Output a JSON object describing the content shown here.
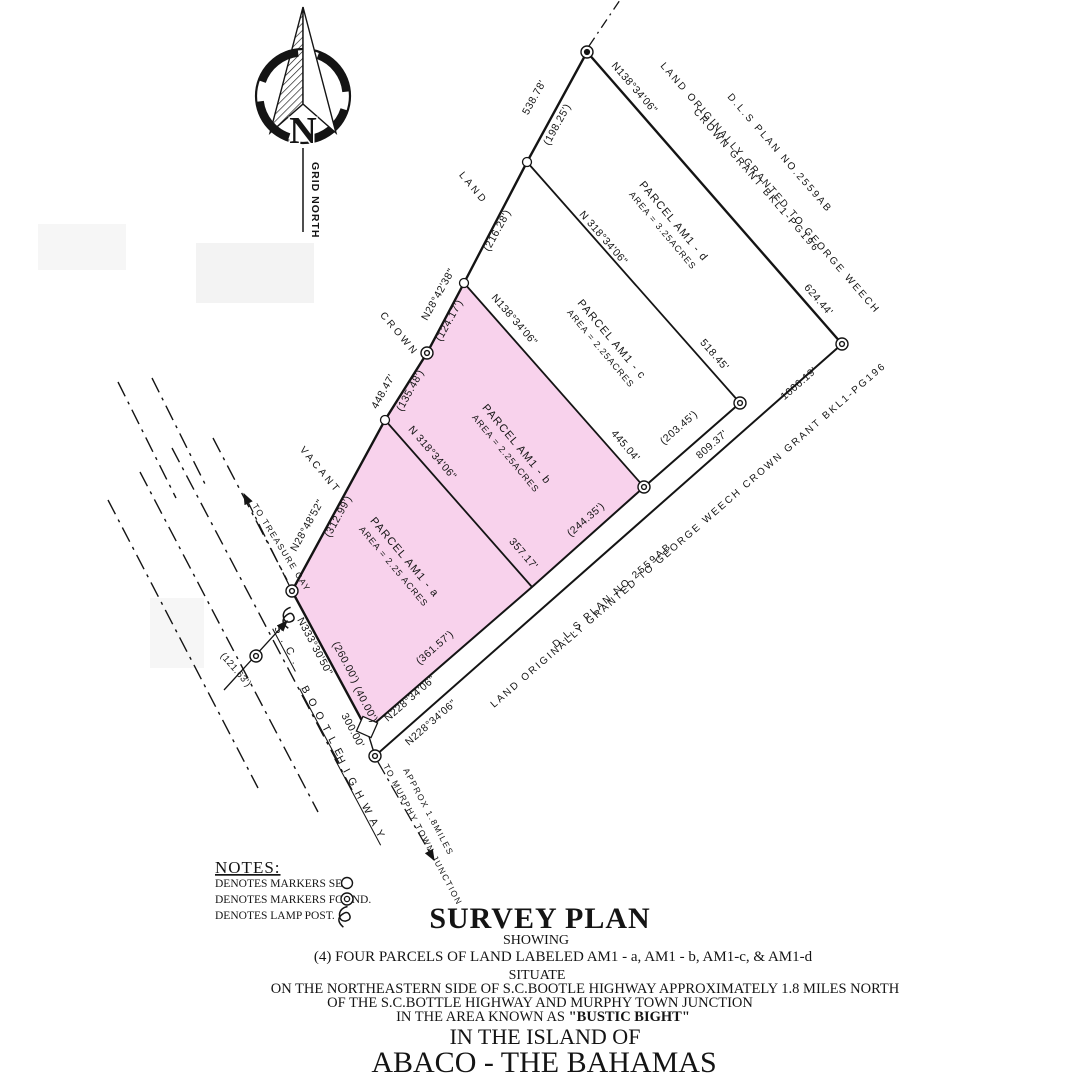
{
  "north_arrow": {
    "letter": "N",
    "caption": "GRID NORTH"
  },
  "parcels": {
    "d": {
      "name": "PARCEL AM1 - d",
      "area": "AREA = 3.25ACRES"
    },
    "c": {
      "name": "PARCEL AM1 - c",
      "area": "AREA = 2.25ACRES"
    },
    "b": {
      "name": "PARCEL AM1 - b",
      "area": "AREA = 2.25ACRES"
    },
    "a": {
      "name": "PARCEL AM1 - a",
      "area": "AREA = 2.25 ACRES"
    }
  },
  "measurements": {
    "nw_upper": {
      "bearing": "N28°42'38\"",
      "total": "538.78'",
      "seg1": "(198.25')",
      "seg2": "(216.28')",
      "seg3": "(124.17')"
    },
    "nw_lower": {
      "bearing": "N28°48'52\"",
      "total": "448.47'",
      "seg1": "(135.48')",
      "seg2": "(312.99')"
    },
    "ne": {
      "bearing": "N138°34'06\"",
      "dist": "624.44'"
    },
    "div_cd": {
      "bearing": "N 318°34'06\"",
      "dist": "518.45'"
    },
    "div_bc": {
      "bearing": "N138°34'06\"",
      "dist": "445.04'"
    },
    "div_ab": {
      "bearing": "N 318°34'06\"",
      "dist": "357.17'"
    },
    "se_inner": {
      "bearing": "N228°34'06\"",
      "total": "809.37'",
      "seg_a": "(361.57')",
      "seg_b": "(244.35')",
      "seg_c": "(203.45')"
    },
    "se_outer": {
      "bearing": "N228°34'06\"",
      "dist": "1006.19'"
    },
    "frontage": {
      "bearing": "N333°30'50\"",
      "total": "300.00'",
      "seg1": "(260.00')",
      "seg2": "(40.00')"
    },
    "tie": {
      "dist": "(121.63')"
    }
  },
  "adjoining": {
    "vacant": "VACANT",
    "crown": "CROWN",
    "land": "LAND",
    "plan_no": "D.L.S PLAN NO.2559AB",
    "grant_line1": "LAND ORIGINALLY GRANTED TO GEORGE WEECH",
    "grant_line2": "CROWN GRANT BKL1-PG196",
    "grant_full": "LAND ORIGINALLY GRANTED TO GEORGE WEECH CROWN GRANT BKL1-PG196"
  },
  "highway": {
    "sc": "S.C.",
    "bootle": "BOOTLE",
    "highway": "HIGHWAY",
    "to_treasure": "TO TREASURE CAY",
    "to_murphy": "TO MURPHY TOWN JUNCTION",
    "approx": "APPROX 1.8MILES"
  },
  "notes": {
    "title": "NOTES:",
    "markers_set": "DENOTES MARKERS  SET.",
    "markers_found": "DENOTES MARKERS FOUND.",
    "lamp_post": "DENOTES LAMP POST."
  },
  "title_block": {
    "line1": "SURVEY PLAN",
    "line2": "SHOWING",
    "line3": "(4) FOUR PARCELS OF LAND LABELED AM1 - a, AM1 - b, AM1-c, & AM1-d",
    "line4": "SITUATE",
    "line5": "ON THE NORTHEASTERN  SIDE OF S.C.BOOTLE HIGHWAY APPROXIMATELY 1.8 MILES NORTH",
    "line6": "OF THE S.C.BOTTLE HIGHWAY AND MURPHY TOWN JUNCTION",
    "line7_prefix": "IN THE AREA KNOWN AS ",
    "line7_bold": "\"BUSTIC BIGHT\"",
    "line8": "IN THE ISLAND OF",
    "line9": "ABACO - THE BAHAMAS"
  },
  "colors": {
    "parcel_fill": "#f8d2ec",
    "ink": "#141414"
  }
}
